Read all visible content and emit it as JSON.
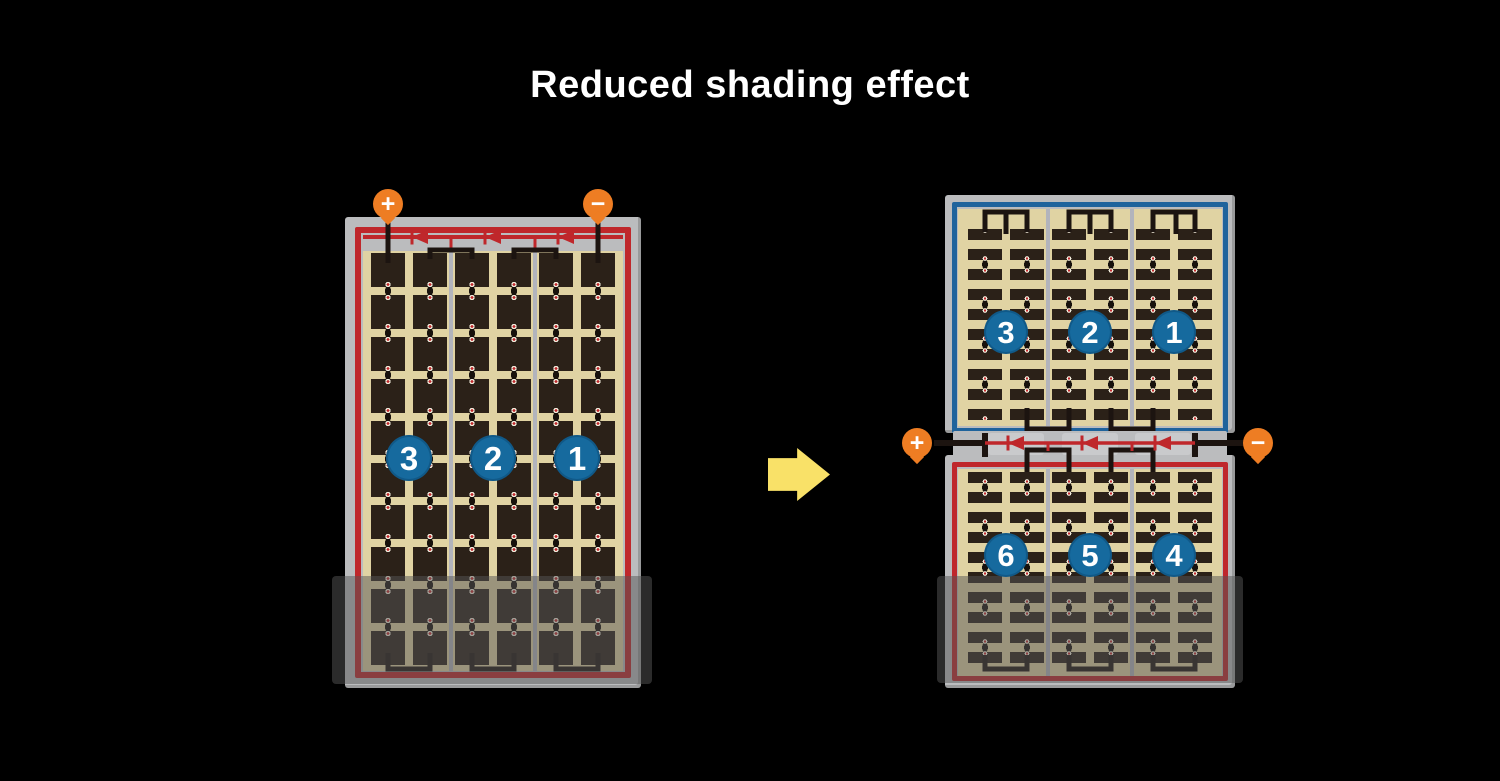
{
  "title": "Reduced shading effect",
  "colors": {
    "background": "#000000",
    "cell_dark": "#2b2118",
    "backsheet_tan": "#e0d3a3",
    "frame_gray": "#bbbcbe",
    "string_red": "#bf272b",
    "string_blue": "#1f639c",
    "terminal_orange": "#ee7d23",
    "number_circle_blue": "#166a9e",
    "arrow_yellow": "#f9e168"
  },
  "left_module": {
    "description": "full-cell module, 3 strings, bottom rows shaded",
    "terminals": {
      "positive": "+",
      "negative": "−"
    },
    "strings": [
      {
        "label": "3"
      },
      {
        "label": "2"
      },
      {
        "label": "1"
      }
    ],
    "bypass_diodes": 3,
    "shaded_region": true
  },
  "right_module": {
    "description": "half-cut-cell module, 6 strings in two halves, center junction with diodes",
    "terminals": {
      "positive": "+",
      "negative": "−"
    },
    "top_half_strings": [
      {
        "label": "3"
      },
      {
        "label": "2"
      },
      {
        "label": "1"
      }
    ],
    "bottom_half_strings": [
      {
        "label": "6"
      },
      {
        "label": "5"
      },
      {
        "label": "4"
      }
    ],
    "bypass_diodes": 3,
    "shaded_region": true
  }
}
